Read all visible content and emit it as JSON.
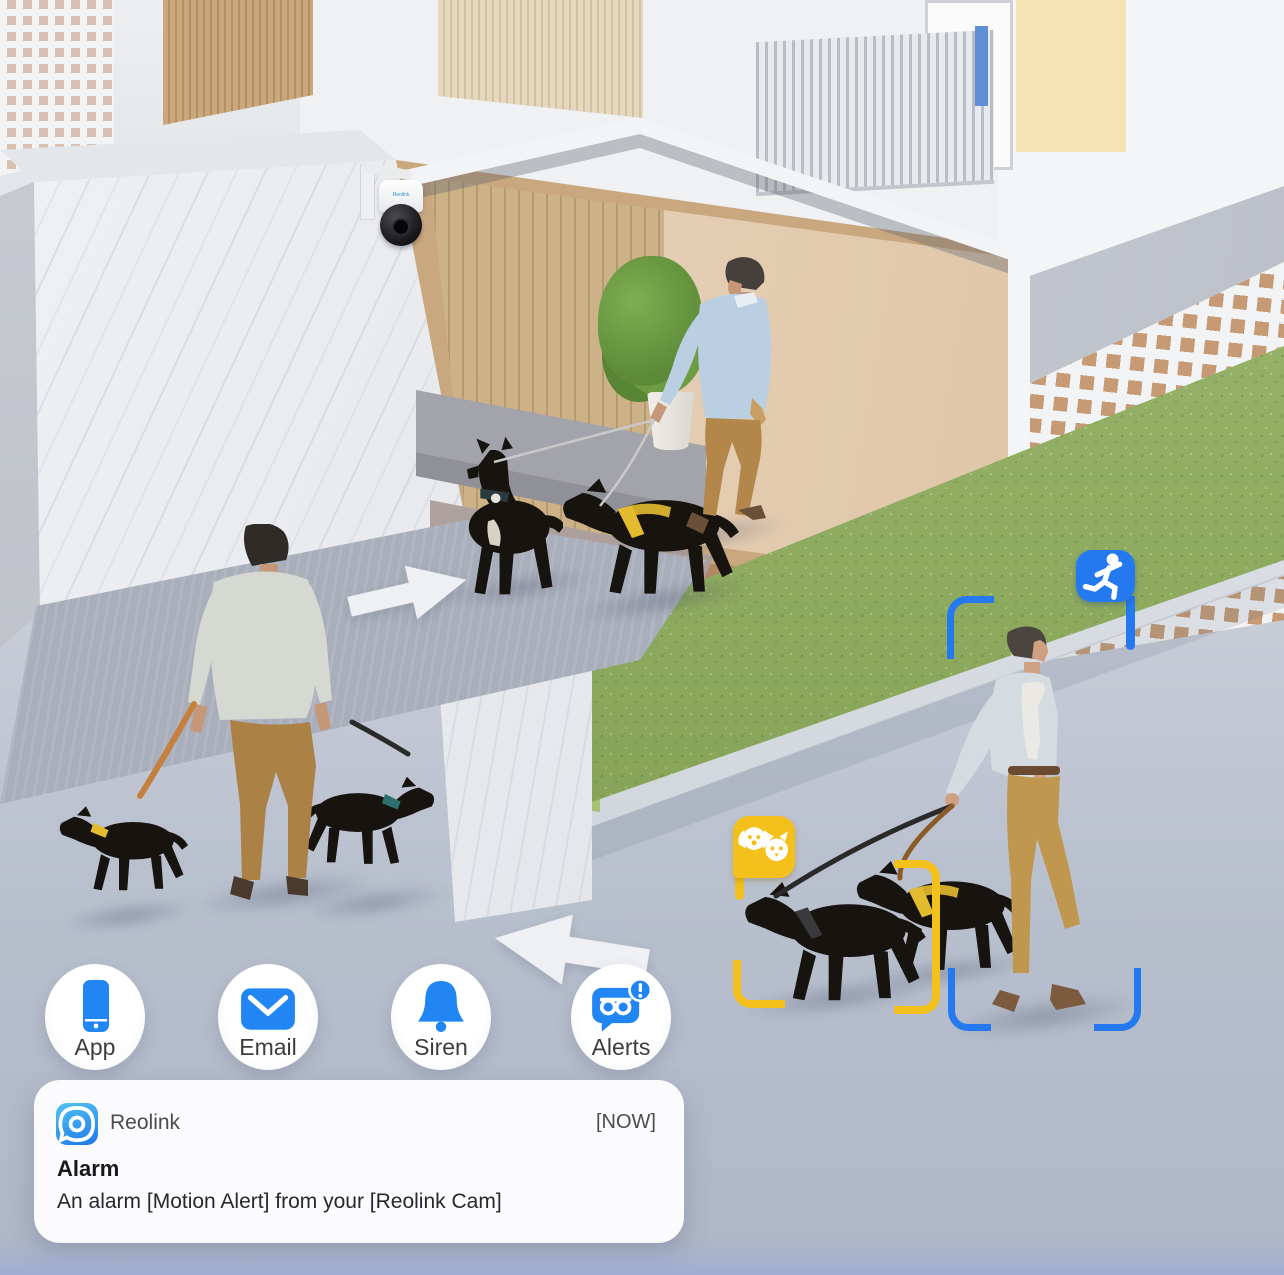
{
  "notification": {
    "app_name": "Reolink",
    "timestamp": "[NOW]",
    "title": "Alarm",
    "body": "An alarm [Motion Alert] from your [Reolink Cam]"
  },
  "alert_channels": [
    {
      "label": "App",
      "icon": "smartphone-icon"
    },
    {
      "label": "Email",
      "icon": "envelope-icon"
    },
    {
      "label": "Siren",
      "icon": "bell-icon"
    },
    {
      "label": "Alerts",
      "icon": "push-alert-icon"
    }
  ],
  "detection": {
    "person_badge_icon": "running-person-icon",
    "pet_badge_icon": "pet-detection-icon",
    "person_box_color": "#2579f0",
    "pet_box_color": "#f3c01c"
  },
  "camera": {
    "brand": "Reolink"
  },
  "colors": {
    "accent_blue": "#2186f3",
    "detection_yellow": "#f3c01c",
    "floor_gray": "#b4bcca",
    "hedge_green": "#8fb05a",
    "notification_bg": "#fbfbfd"
  }
}
